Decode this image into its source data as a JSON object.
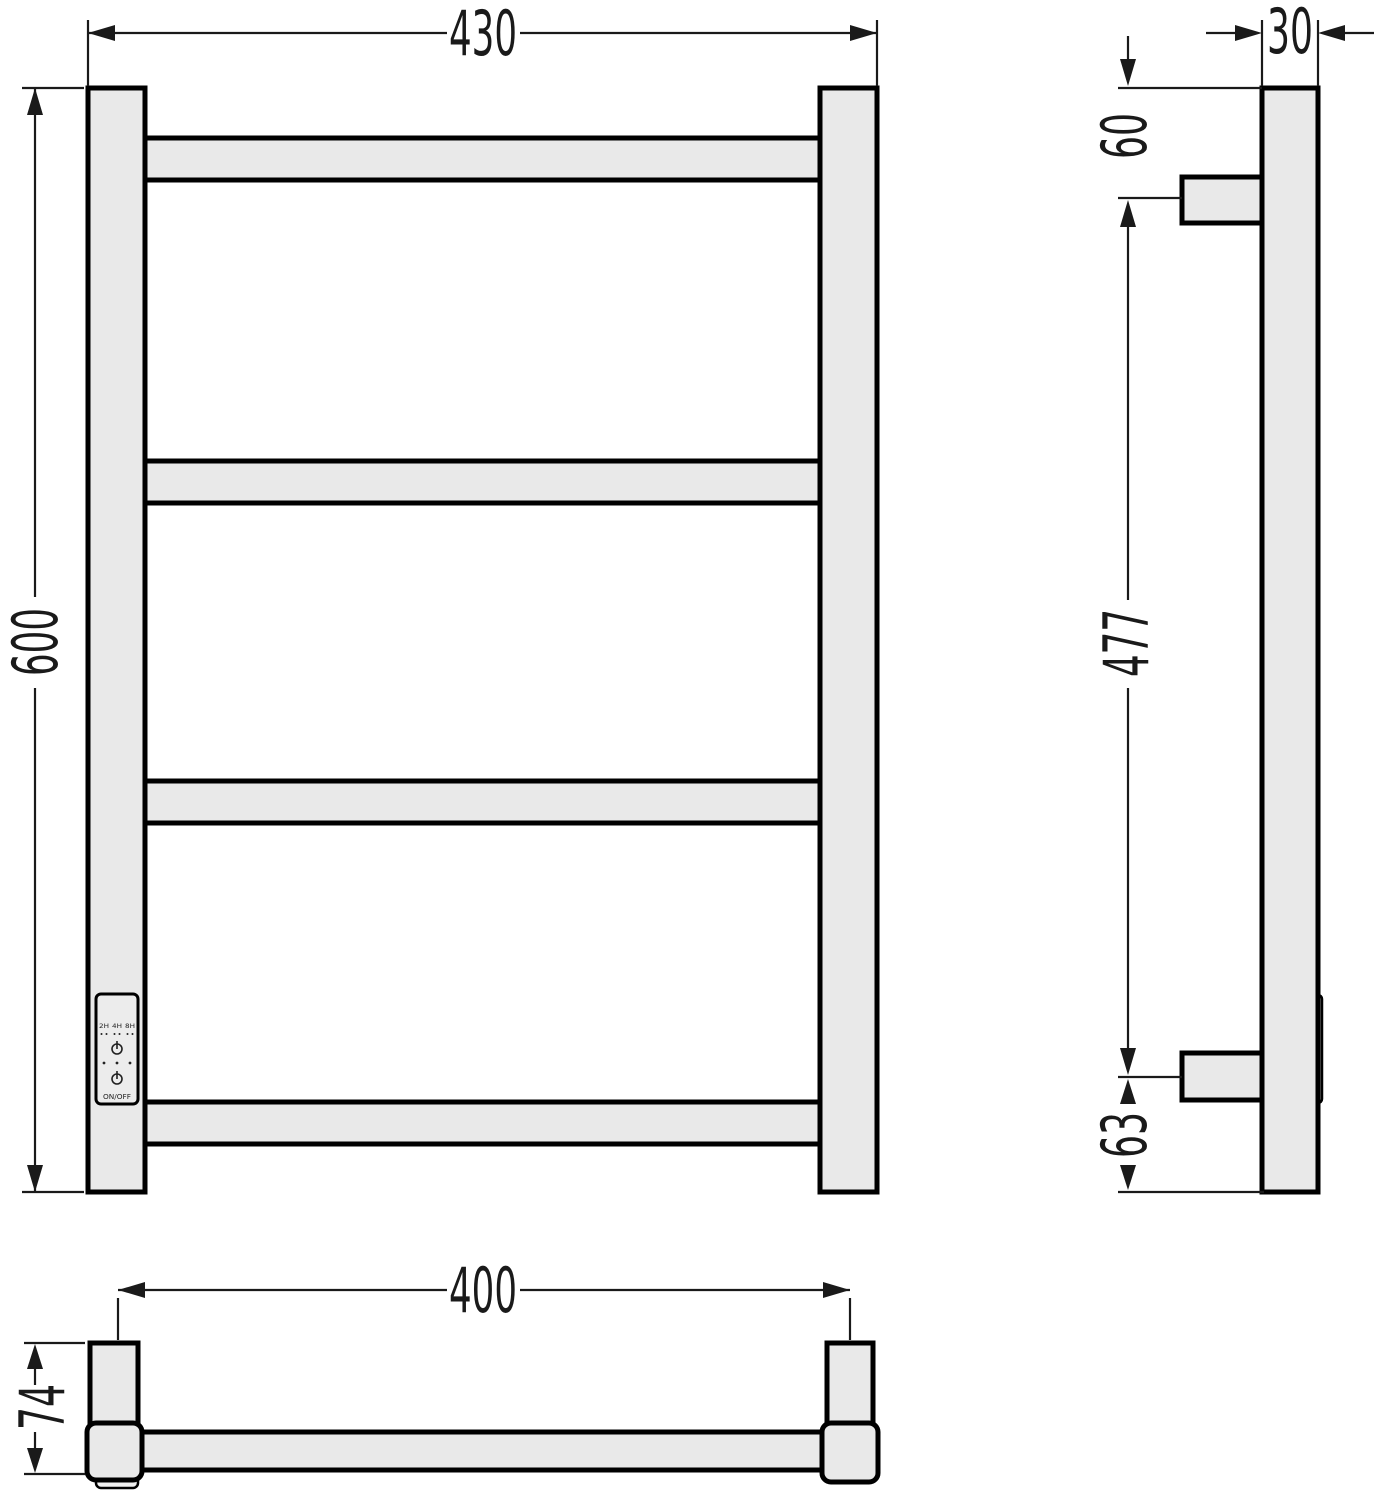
{
  "dimensions": {
    "front": {
      "width": "430",
      "height": "600"
    },
    "side": {
      "tube_depth": "30",
      "top_to_bracket": "60",
      "bracket_span": "477",
      "bracket_to_bottom": "63"
    },
    "bottom": {
      "bracket_spacing": "400",
      "depth": "74"
    }
  },
  "control_panel": {
    "timer_labels": [
      "2H",
      "4H",
      "8H"
    ],
    "power_button_label": "ON/OFF"
  },
  "colors": {
    "outline": "#000000",
    "fill": "#e9e9e9",
    "background": "#ffffff"
  }
}
